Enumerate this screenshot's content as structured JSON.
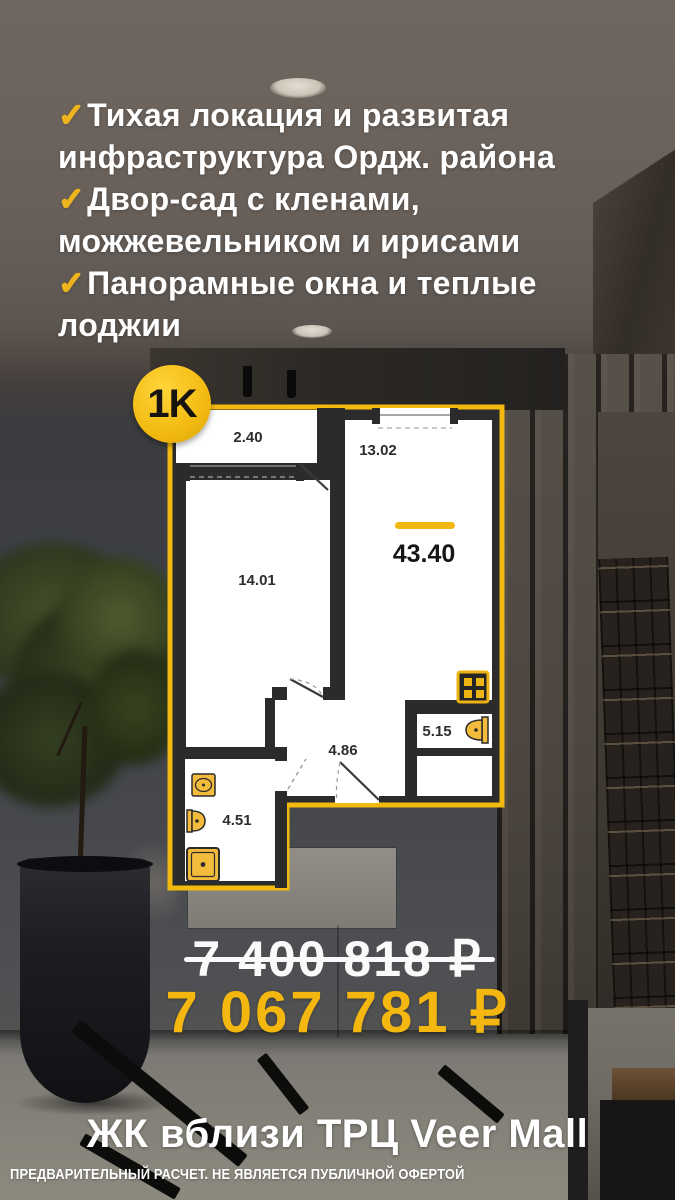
{
  "check_symbol": "✓",
  "features": [
    {
      "lines": [
        "Тихая локация и развитая",
        "инфраструктура Ордж. района"
      ]
    },
    {
      "lines": [
        "Двор-сад с кленами,",
        "можжевельником и ирисами"
      ]
    },
    {
      "lines": [
        "Панорамные окна и теплые",
        "лоджии"
      ]
    }
  ],
  "badge": {
    "label": "1K"
  },
  "floor_plan": {
    "total_area": "43.40",
    "rooms": [
      {
        "id": "loggia",
        "area": "2.40"
      },
      {
        "id": "kitchen-living",
        "area": "13.02"
      },
      {
        "id": "room",
        "area": "14.01"
      },
      {
        "id": "hallway",
        "area": "4.86"
      },
      {
        "id": "bathroom",
        "area": "5.15"
      },
      {
        "id": "bathroom-2",
        "area": "4.51"
      }
    ],
    "fixtures": [
      "stove-icon",
      "toilet-icon",
      "sink-icon",
      "toilet-icon",
      "shower-icon"
    ]
  },
  "pricing": {
    "old_price": "7 400 818 ₽",
    "new_price": "7 067 781 ₽"
  },
  "footer": {
    "title": "ЖК вблизи ТРЦ Veer Mall",
    "disclaimer": "ПРЕДВАРИТЕЛЬНЫЙ РАСЧЕТ. НЕ ЯВЛЯЕТСЯ ПУБЛИЧНОЙ ОФЕРТОЙ"
  },
  "colors": {
    "accent_yellow": "#f3b710",
    "check_yellow": "#edb41e",
    "plan_border": "#f2b90f",
    "plan_wall": "#2b2b2b"
  }
}
